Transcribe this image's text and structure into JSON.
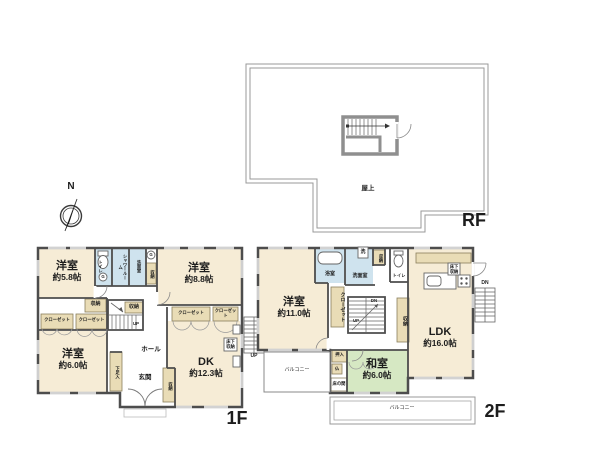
{
  "palette": {
    "wall": "#4d4d4d",
    "rf_line": "#999999",
    "stair_wall": "#8f8f8f",
    "room": "#f6ecd6",
    "wet": "#cfe3ee",
    "tatami": "#d6e8c3",
    "storage": "#e9dcb6",
    "white": "#ffffff"
  },
  "compass": {
    "north": "N"
  },
  "rf": {
    "floor_label": "RF",
    "rooftop": "屋上"
  },
  "f1": {
    "floor_label": "1F",
    "west58": {
      "name": "洋室",
      "area": "約5.8帖"
    },
    "west88": {
      "name": "洋室",
      "area": "約8.8帖"
    },
    "west60": {
      "name": "洋室",
      "area": "約6.0帖"
    },
    "dk": {
      "name": "DK",
      "area": "約12.3帖"
    },
    "toilet": "トイレ",
    "shower": "シャワールーム",
    "washroom": "洗面室",
    "gas": "G",
    "storage": "収納",
    "closet": "クローゼット",
    "hall": "ホール",
    "entrance": "玄関",
    "shoe_box": "下足入",
    "underfloor": "床下収納",
    "up": "UP"
  },
  "f2": {
    "floor_label": "2F",
    "west110": {
      "name": "洋室",
      "area": "約11.0帖"
    },
    "washitsu": {
      "name": "和室",
      "area": "約6.0帖"
    },
    "ldk": {
      "name": "LDK",
      "area": "約16.0帖"
    },
    "bath": "浴室",
    "laundry": "洗",
    "washroom": "洗面室",
    "toilet": "トイレ",
    "storage": "収納",
    "closet": "クローゼット",
    "underfloor": "床下収納",
    "oshiire": "押入",
    "butsuma": "仏",
    "tokonoma": "床の間",
    "balcony": "バルコニー",
    "up": "UP",
    "dn": "DN"
  }
}
